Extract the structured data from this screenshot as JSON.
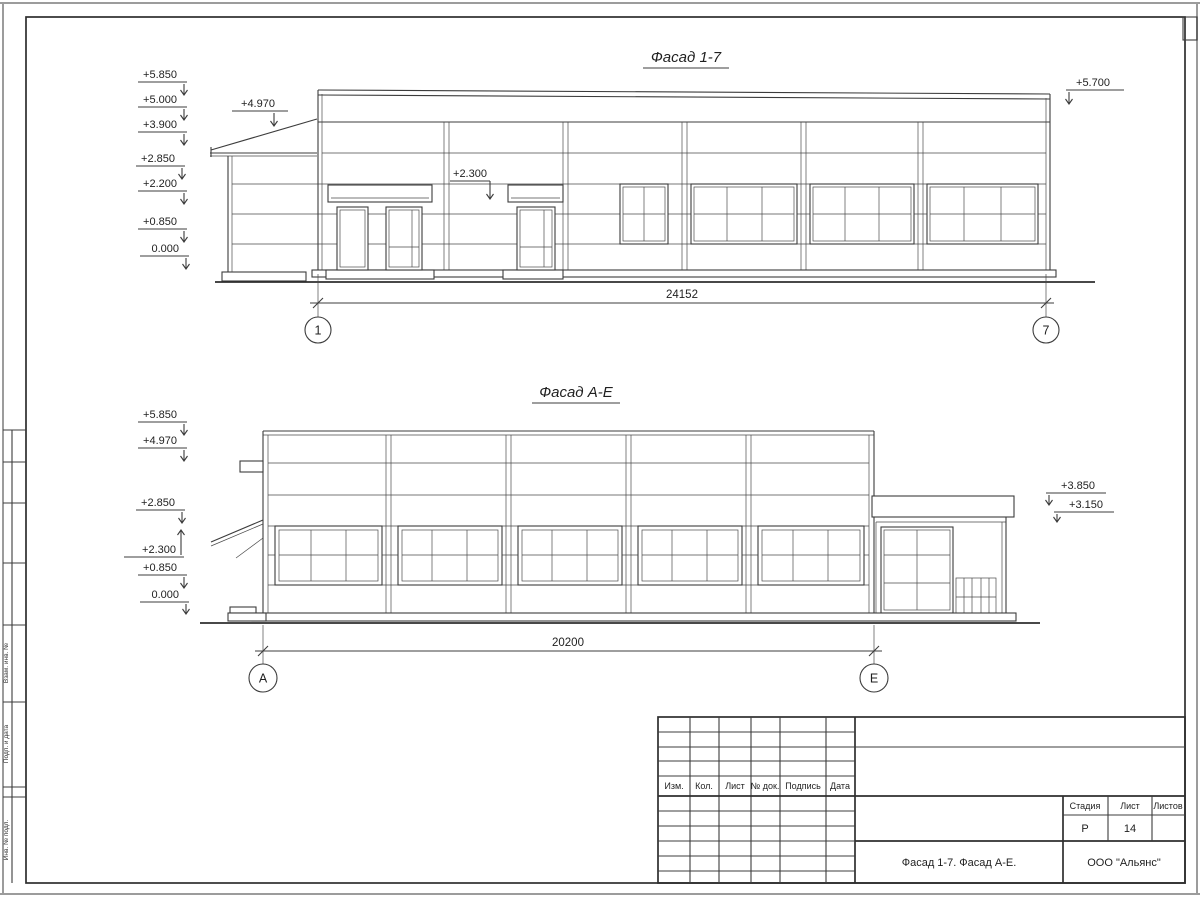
{
  "sheet": {
    "bg": "#ffffff",
    "line_color": "#3c3c3c"
  },
  "facade_1_7": {
    "title": "Фасад 1-7",
    "left_marks": [
      "+5.850",
      "+5.000",
      "+3.900",
      "+2.850",
      "+2.200",
      "+0.850",
      "0.000"
    ],
    "canopy_mark": "+4.970",
    "lintel_mark": "+2.300",
    "right_mark": "+5.700",
    "dimension": "24152",
    "axis_left": "1",
    "axis_right": "7"
  },
  "facade_a_e": {
    "title": "Фасад А-Е",
    "left_marks": [
      "+5.850",
      "+4.970",
      "+2.850",
      "+2.300",
      "+0.850",
      "0.000"
    ],
    "right_marks": [
      "+3.850",
      "+3.150"
    ],
    "dimension": "20200",
    "axis_left": "А",
    "axis_right": "Е"
  },
  "left_margin": {
    "labels": [
      "Взам. инв. №",
      "Подп. и дата",
      "Инв. № подл."
    ]
  },
  "title_block": {
    "revision_headers": [
      "Изм.",
      "Кол.",
      "Лист",
      "№ док.",
      "Подпись",
      "Дата"
    ],
    "stage_label": "Стадия",
    "sheet_label": "Лист",
    "sheets_label": "Листов",
    "stage_value": "Р",
    "sheet_value": "14",
    "sheets_value": "",
    "doc_title": "Фасад 1-7. Фасад А-Е.",
    "company": "ООО \"Альянс\""
  }
}
